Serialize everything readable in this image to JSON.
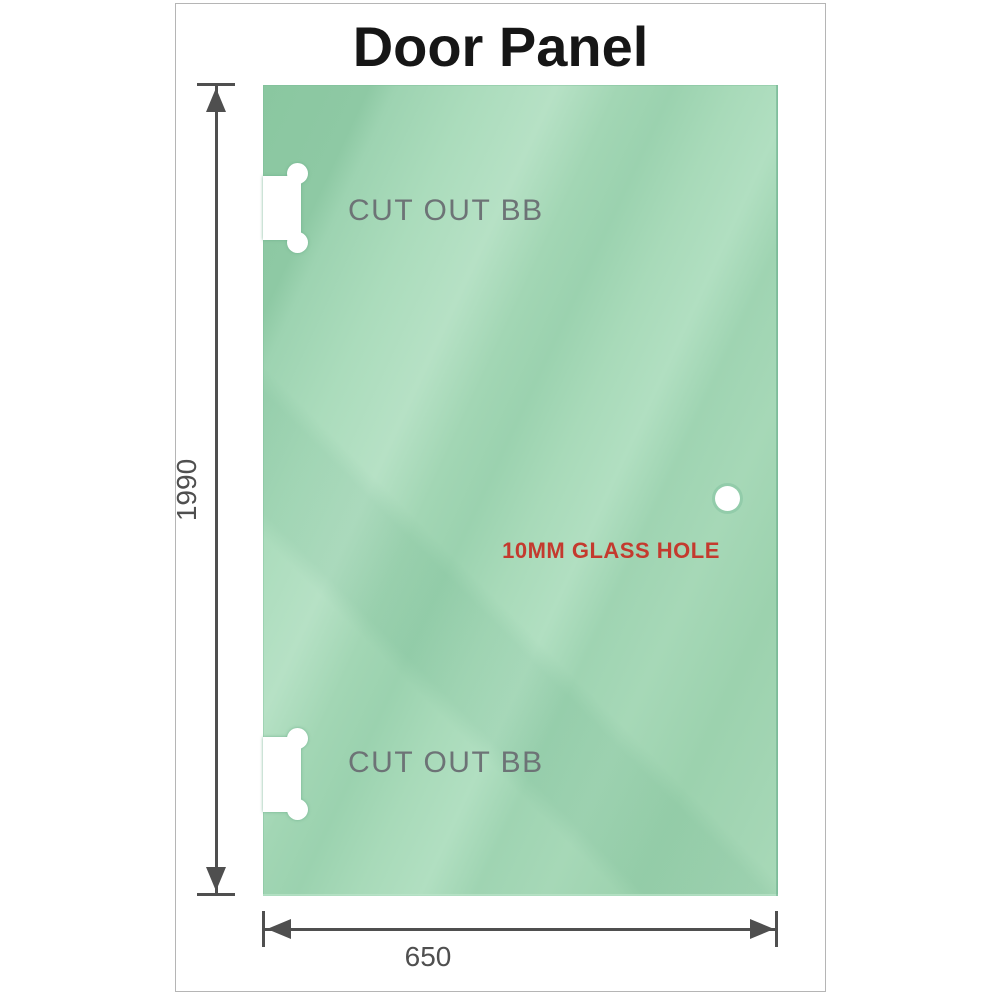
{
  "title": "Door Panel",
  "panel": {
    "description": "glass door panel drawing",
    "height_dimension": "1990",
    "width_dimension": "650",
    "cutouts": [
      {
        "position": "top-left",
        "label": "CUT OUT BB"
      },
      {
        "position": "bottom-left",
        "label": "CUT OUT BB"
      }
    ],
    "hole": {
      "label": "10MM GLASS HOLE"
    }
  },
  "colors": {
    "glass_base": "#9bd2af",
    "glass_dark": "#8ac7a0",
    "glass_light": "#b6e1c5",
    "dimension_gray": "#4f4f4f",
    "cutout_label_gray": "#6d7376",
    "hole_label_red": "#c43a2e",
    "frame_border": "#b5b5b5",
    "title_color": "#161616"
  }
}
